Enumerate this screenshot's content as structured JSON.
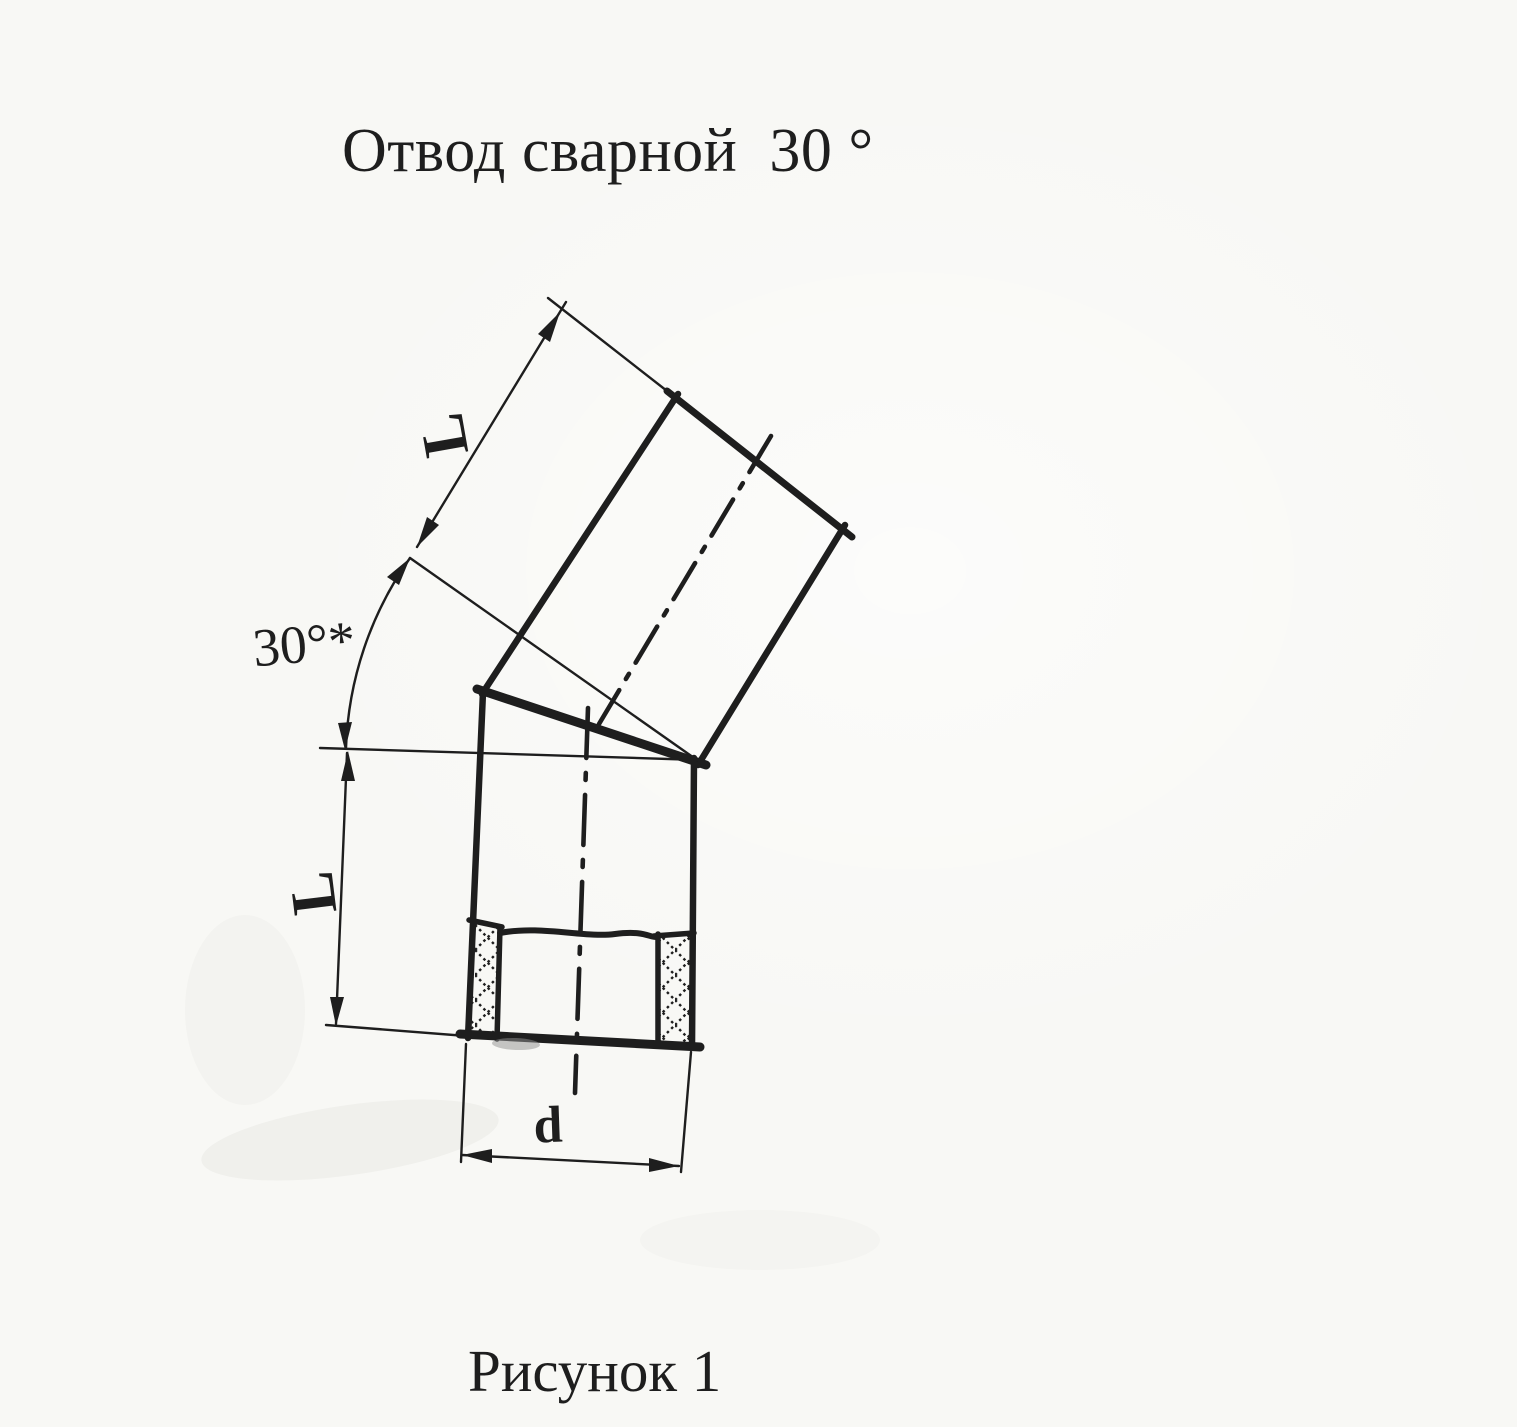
{
  "theme": {
    "ink": "#1e1e1e",
    "paper": "#f8f8f5"
  },
  "title": "Отвод сварной  30 °",
  "figure": {
    "caption": "Рисунок 1",
    "labels": {
      "upper_length": "L",
      "lower_length": "L",
      "angle": "30°*",
      "diameter": "d"
    }
  }
}
